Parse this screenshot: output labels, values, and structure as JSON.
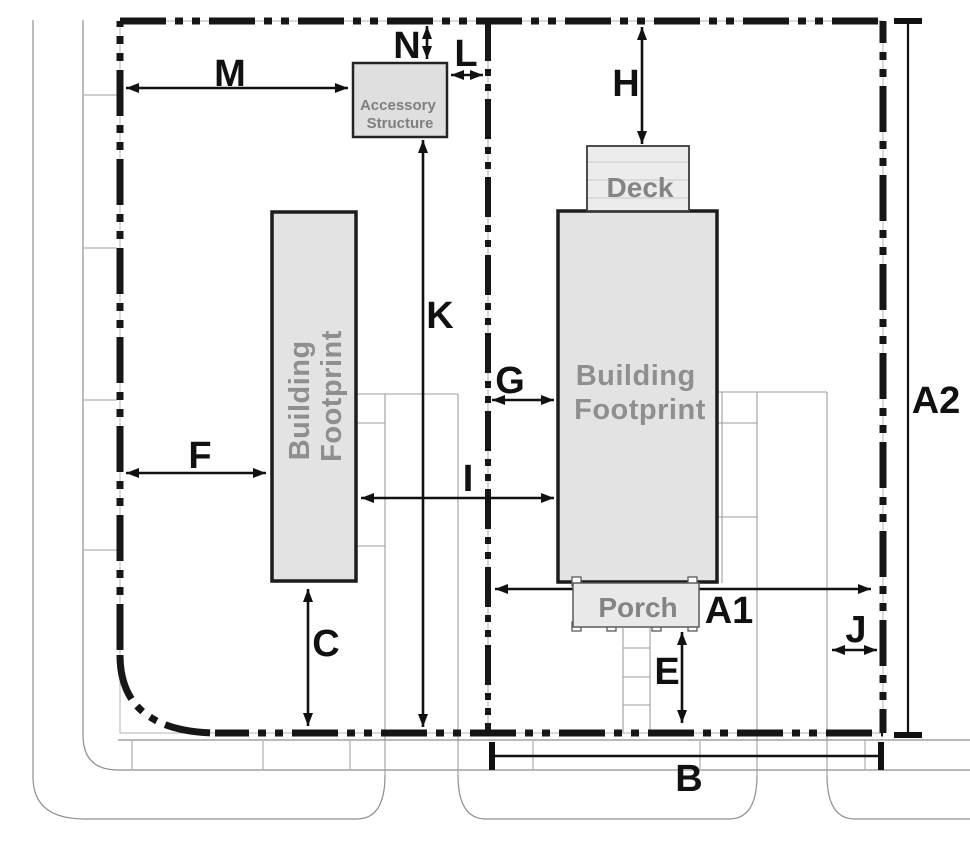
{
  "dims": {
    "a1": "A1",
    "a2": "A2",
    "b": "B",
    "c": "C",
    "e": "E",
    "f": "F",
    "g": "G",
    "h": "H",
    "i": "I",
    "j": "J",
    "k": "K",
    "l": "L",
    "m": "M",
    "n": "N"
  },
  "structures": {
    "accessory": {
      "line1": "Accessory",
      "line2": "Structure"
    },
    "left_building": {
      "line1": "Building",
      "line2": "Footprint"
    },
    "right_building": {
      "line1": "Building",
      "line2": "Footprint"
    },
    "deck": "Deck",
    "porch": "Porch"
  },
  "colors": {
    "boundary": "#161616",
    "dimension": "#111111",
    "building_fill": "#e3e3e3",
    "building_stroke": "#1c1c1c",
    "site_line": "#8f8f8f",
    "muted_text": "#8a8a8a"
  }
}
